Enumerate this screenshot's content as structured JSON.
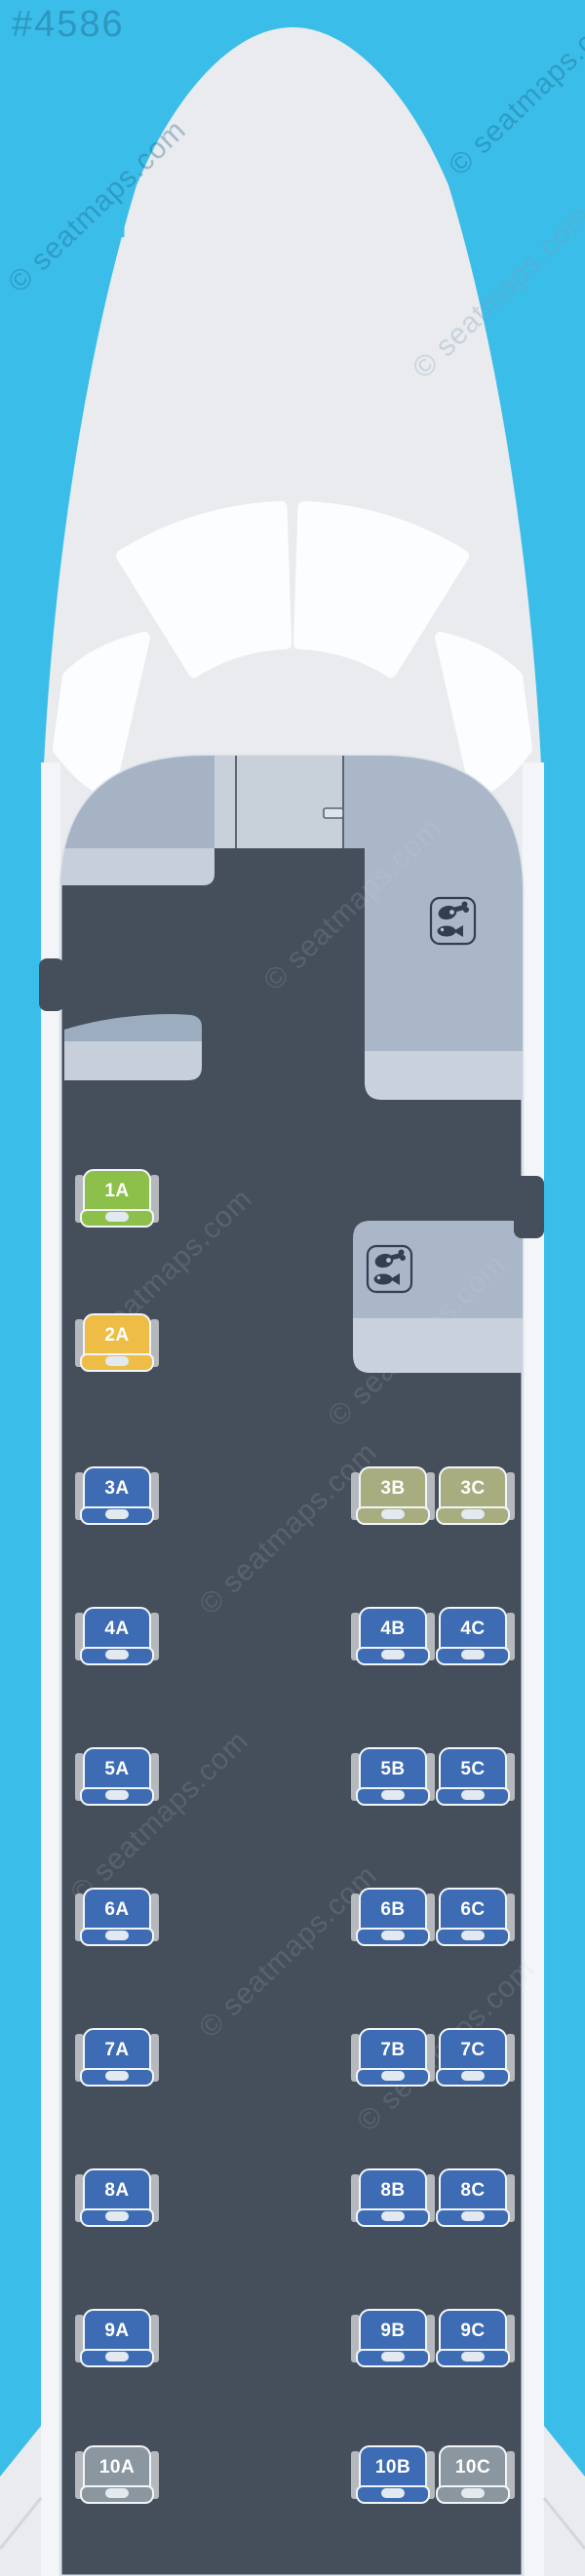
{
  "page": {
    "map_number": "#4586",
    "watermark_text": "© seatmaps.com"
  },
  "palette": {
    "sky": "#3bbde9",
    "fuselage": "#e9ebee",
    "fuselage_wall": "#f3f5f8",
    "windshield": "#fcfdfe",
    "cabin": "#454e5b",
    "arch_outline": "#dce3e9",
    "panel_left": "#a5b3c5",
    "panel_door": "#c8d0da",
    "panel_right": "#a9b7c8",
    "panel_band": "#c6cfda",
    "galley_shelf_top": "#9dadc0",
    "door_line": "#5b6574",
    "door_handle_fill": "#dde4ec",
    "icon_stroke": "#333e52",
    "armrest": "#b5b8bc",
    "seat_border": "#f2f5f8",
    "seat_pill": "#e2e9f0",
    "seat_colors": {
      "blue": "#3d6cb4",
      "green": "#8cc04a",
      "yellow": "#eebd46",
      "olive": "#a8ad80",
      "gray": "#8b97a0"
    }
  },
  "icons": {
    "galley_boxes": [
      {
        "name": "galley-meal-icon-front",
        "glyphs": [
          "poultry-leg-icon",
          "fish-icon"
        ]
      },
      {
        "name": "galley-meal-icon-mid",
        "glyphs": [
          "poultry-leg-icon",
          "fish-icon"
        ]
      }
    ]
  },
  "seatmap": {
    "columns": [
      "A",
      "B",
      "C"
    ],
    "seats": [
      {
        "id": "1A",
        "row": 1,
        "col": "A",
        "color": "green"
      },
      {
        "id": "2A",
        "row": 2,
        "col": "A",
        "color": "yellow"
      },
      {
        "id": "3A",
        "row": 3,
        "col": "A",
        "color": "blue"
      },
      {
        "id": "3B",
        "row": 3,
        "col": "B",
        "color": "olive"
      },
      {
        "id": "3C",
        "row": 3,
        "col": "C",
        "color": "olive"
      },
      {
        "id": "4A",
        "row": 4,
        "col": "A",
        "color": "blue"
      },
      {
        "id": "4B",
        "row": 4,
        "col": "B",
        "color": "blue"
      },
      {
        "id": "4C",
        "row": 4,
        "col": "C",
        "color": "blue"
      },
      {
        "id": "5A",
        "row": 5,
        "col": "A",
        "color": "blue"
      },
      {
        "id": "5B",
        "row": 5,
        "col": "B",
        "color": "blue"
      },
      {
        "id": "5C",
        "row": 5,
        "col": "C",
        "color": "blue"
      },
      {
        "id": "6A",
        "row": 6,
        "col": "A",
        "color": "blue"
      },
      {
        "id": "6B",
        "row": 6,
        "col": "B",
        "color": "blue"
      },
      {
        "id": "6C",
        "row": 6,
        "col": "C",
        "color": "blue"
      },
      {
        "id": "7A",
        "row": 7,
        "col": "A",
        "color": "blue"
      },
      {
        "id": "7B",
        "row": 7,
        "col": "B",
        "color": "blue"
      },
      {
        "id": "7C",
        "row": 7,
        "col": "C",
        "color": "blue"
      },
      {
        "id": "8A",
        "row": 8,
        "col": "A",
        "color": "blue"
      },
      {
        "id": "8B",
        "row": 8,
        "col": "B",
        "color": "blue"
      },
      {
        "id": "8C",
        "row": 8,
        "col": "C",
        "color": "blue"
      },
      {
        "id": "9A",
        "row": 9,
        "col": "A",
        "color": "blue"
      },
      {
        "id": "9B",
        "row": 9,
        "col": "B",
        "color": "blue"
      },
      {
        "id": "9C",
        "row": 9,
        "col": "C",
        "color": "blue"
      },
      {
        "id": "10A",
        "row": 10,
        "col": "A",
        "color": "gray"
      },
      {
        "id": "10B",
        "row": 10,
        "col": "B",
        "color": "blue"
      },
      {
        "id": "10C",
        "row": 10,
        "col": "C",
        "color": "gray"
      }
    ]
  }
}
